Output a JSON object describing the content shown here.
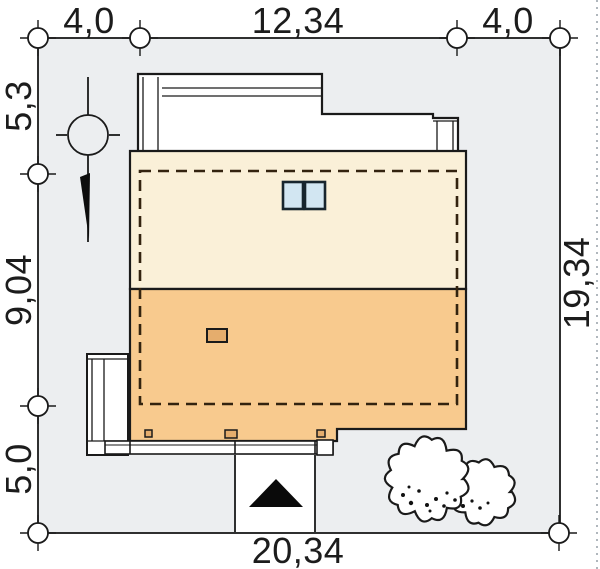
{
  "drawing": {
    "type": "architectural-site-plan",
    "dimension_labels": {
      "top": [
        "4,0",
        "12,34",
        "4,0"
      ],
      "left": [
        "5,3",
        "9,04",
        "5,0"
      ],
      "right": [
        "19,34"
      ],
      "bottom": [
        "20,34"
      ]
    },
    "colors": {
      "background": "#ffffff",
      "plot_fill": "#eceef0",
      "roof_upper": "#faf0d8",
      "roof_lower": "#f8ca8e",
      "chimney": "#e5ad6d",
      "skylight": "#d2e6f2",
      "outline": "#1a1a1a",
      "footprint_dash": "#33230f"
    }
  }
}
